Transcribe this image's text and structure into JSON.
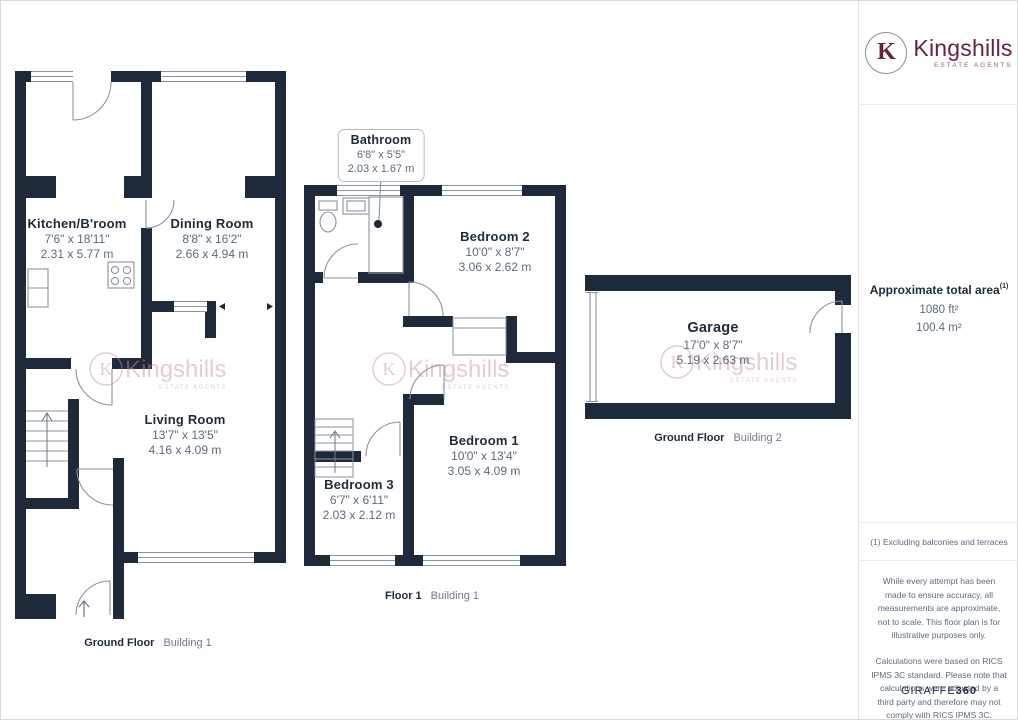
{
  "brand": {
    "monogram": "K",
    "name": "Kingshills",
    "tagline": "ESTATE AGENTS"
  },
  "plan": {
    "callout": {
      "name": "Bathroom",
      "imperial": "6'8\" x 5'5\"",
      "metric": "2.03 x 1.67 m"
    },
    "rooms": {
      "kitchen": {
        "name": "Kitchen/B'room",
        "imperial": "7'6\" x 18'11\"",
        "metric": "2.31 x 5.77 m"
      },
      "dining": {
        "name": "Dining Room",
        "imperial": "8'8\" x 16'2\"",
        "metric": "2.66 x 4.94 m"
      },
      "living": {
        "name": "Living Room",
        "imperial": "13'7\" x 13'5\"",
        "metric": "4.16 x 4.09 m"
      },
      "bedroom2": {
        "name": "Bedroom 2",
        "imperial": "10'0\" x 8'7\"",
        "metric": "3.06 x 2.62 m"
      },
      "bedroom1": {
        "name": "Bedroom 1",
        "imperial": "10'0\" x 13'4\"",
        "metric": "3.05 x 4.09 m"
      },
      "bedroom3": {
        "name": "Bedroom 3",
        "imperial": "6'7\" x 6'11\"",
        "metric": "2.03 x 2.12 m"
      },
      "garage": {
        "name": "Garage",
        "imperial": "17'0\" x 8'7\"",
        "metric": "5.19 x 2.63 m"
      }
    },
    "floor_labels": {
      "building1_ground": {
        "floor": "Ground Floor",
        "building": "Building 1"
      },
      "building1_first": {
        "floor": "Floor 1",
        "building": "Building 1"
      },
      "building2_ground": {
        "floor": "Ground Floor",
        "building": "Building 2"
      }
    },
    "colors": {
      "wall": "#1e2a3a",
      "dim_text": "#5d6b7e",
      "watermark": "#c98da3"
    }
  },
  "sidebar": {
    "total_area": {
      "label": "Approximate total area",
      "marker": "(1)",
      "imperial": "1080 ft²",
      "metric": "100.4 m²"
    },
    "footnote": "(1) Excluding balconies and terraces",
    "disclaimers": [
      "While every attempt has been made to ensure accuracy, all measurements are approximate, not to scale. This floor plan is for illustrative purposes only.",
      "Calculations were based on RICS IPMS 3C standard. Please note that calculations were adjusted by a third party and therefore may not comply with RICS IPMS 3C."
    ],
    "provider": {
      "name": "GIRAFFE",
      "suffix": "360"
    }
  }
}
